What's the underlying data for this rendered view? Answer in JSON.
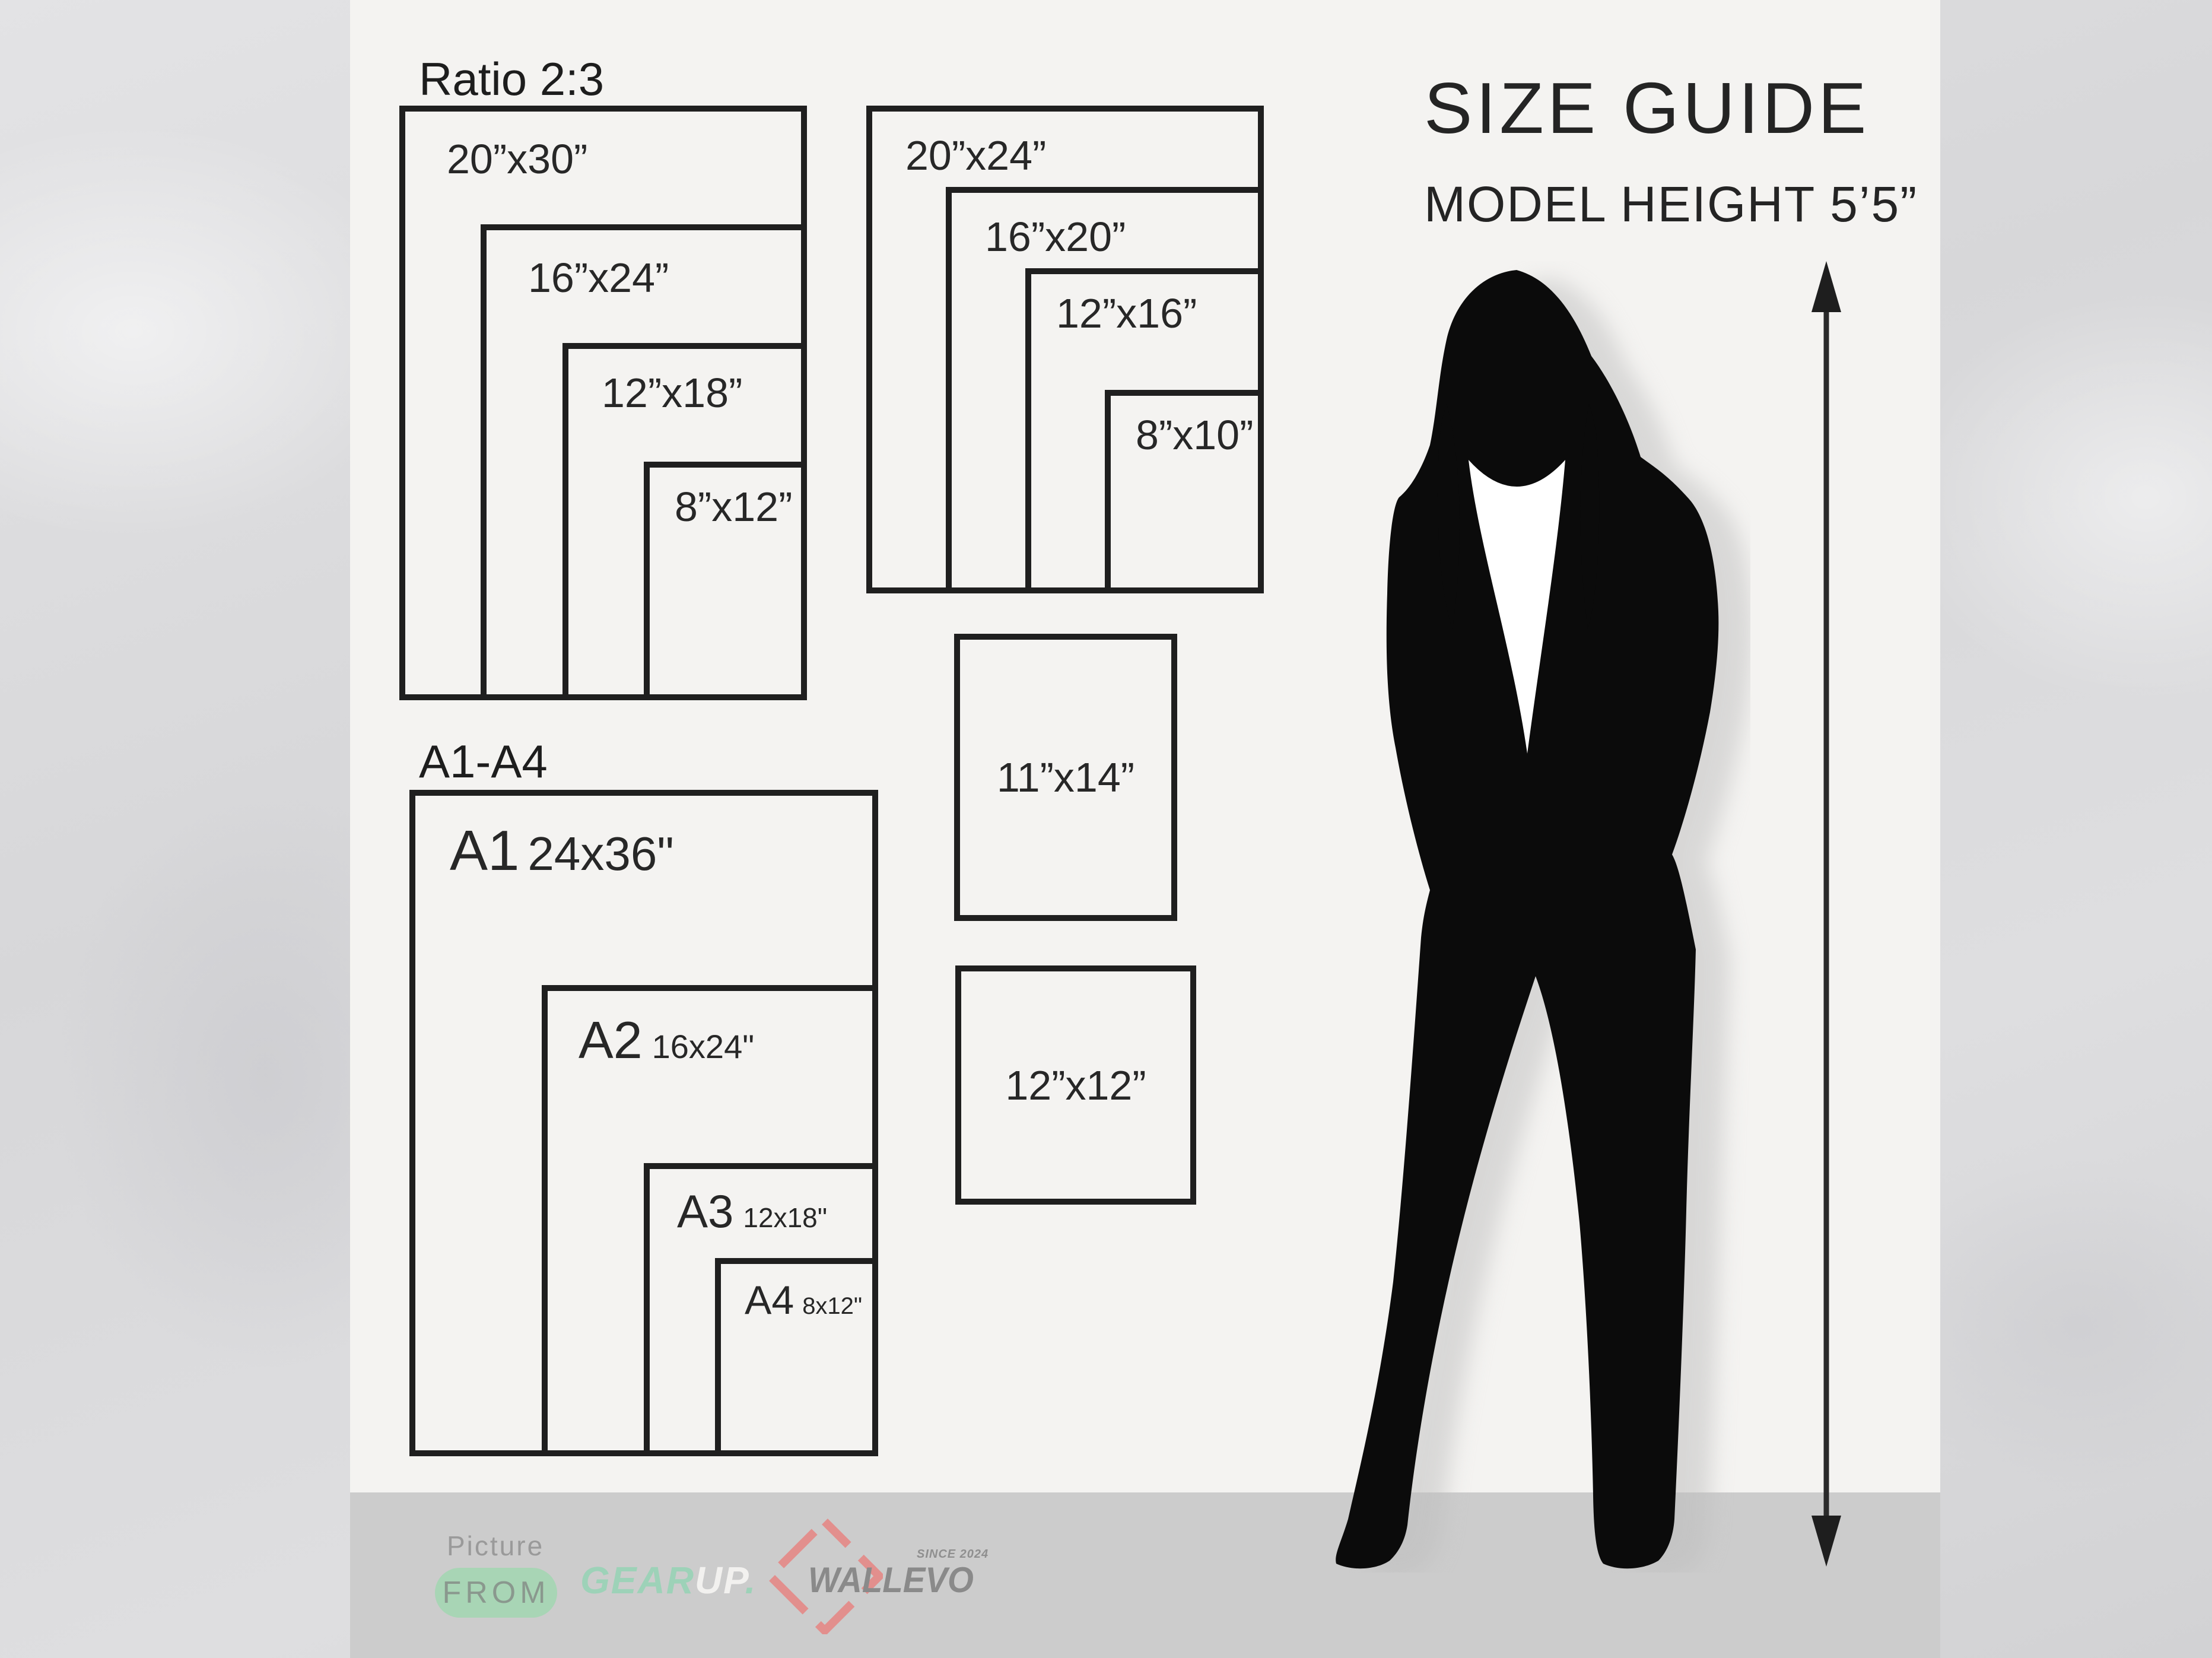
{
  "size_guide": {
    "title": "SIZE GUIDE",
    "model_height": "MODEL HEIGHT 5’5”",
    "ratio_group": {
      "heading": "Ratio 2:3",
      "sizes": [
        "20”x30”",
        "16”x24”",
        "12”x18”",
        "8”x12”"
      ]
    },
    "standard_group": {
      "sizes": [
        "20”x24”",
        "16”x20”",
        "12”x16”",
        "8”x10”"
      ]
    },
    "square_boxes": [
      "11”x14”",
      "12”x12”"
    ],
    "a_series": {
      "heading": "A1-A4",
      "items": [
        {
          "code": "A1",
          "size": "24x36\""
        },
        {
          "code": "A2",
          "size": "16x24\""
        },
        {
          "code": "A3",
          "size": "12x18\""
        },
        {
          "code": "A4",
          "size": "8x12\""
        }
      ]
    }
  },
  "footer": {
    "picture_label": "Picture",
    "from_label": "FROM",
    "brand1_part1": "GEAR",
    "brand1_part2": "UP",
    "brand1_dot": ".",
    "brand2": "WALLEVO",
    "since": "SINCE 2024"
  },
  "colors": {
    "panel": "#f4f3f1",
    "footer_gray": "#cccccc",
    "box_border": "#1f1f1f",
    "accent_green": "#9dd2b8",
    "pill_green": "#a8d5b5",
    "coral": "#e28f8d",
    "silhouette_black": "#0b0b0b"
  }
}
